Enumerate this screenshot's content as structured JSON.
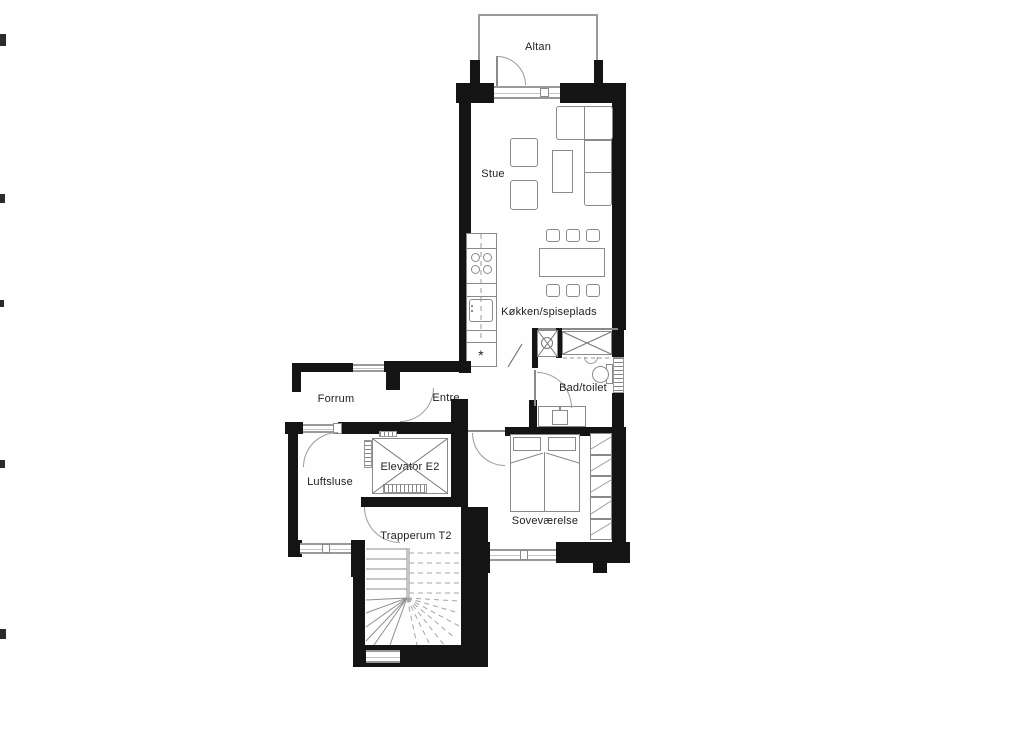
{
  "rooms": {
    "altan": "Altan",
    "stue": "Stue",
    "kitchen": "Køkken/spiseplads",
    "bath": "Bad/toilet",
    "entre": "Entre",
    "forrum": "Forrum",
    "luftsluse": "Luftsluse",
    "elevator": "Elevator E2",
    "stairwell": "Trapperum T2",
    "bedroom": "Soveværelse"
  },
  "symbols": {
    "kitchen_vent": "*"
  },
  "colors": {
    "wall": "#141414",
    "line": "#8a8a8a",
    "label": "#222222"
  }
}
